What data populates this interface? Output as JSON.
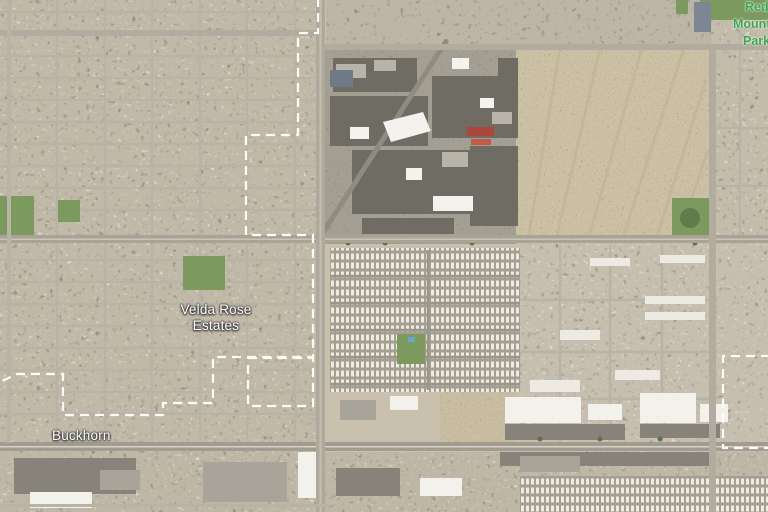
{
  "map": {
    "view": "satellite",
    "labels": {
      "velda_rose_estates": {
        "line1": "Velda Rose",
        "line2": "Estates"
      },
      "buckhorn": {
        "text": "Buckhorn"
      },
      "red_mountain_park": {
        "lines": [
          "Red",
          "Mountain",
          "Park"
        ]
      }
    },
    "colors": {
      "neighborhood_label": "#ffffff",
      "park_label": "#3fa351",
      "boundary_line": "#ffffff"
    }
  }
}
